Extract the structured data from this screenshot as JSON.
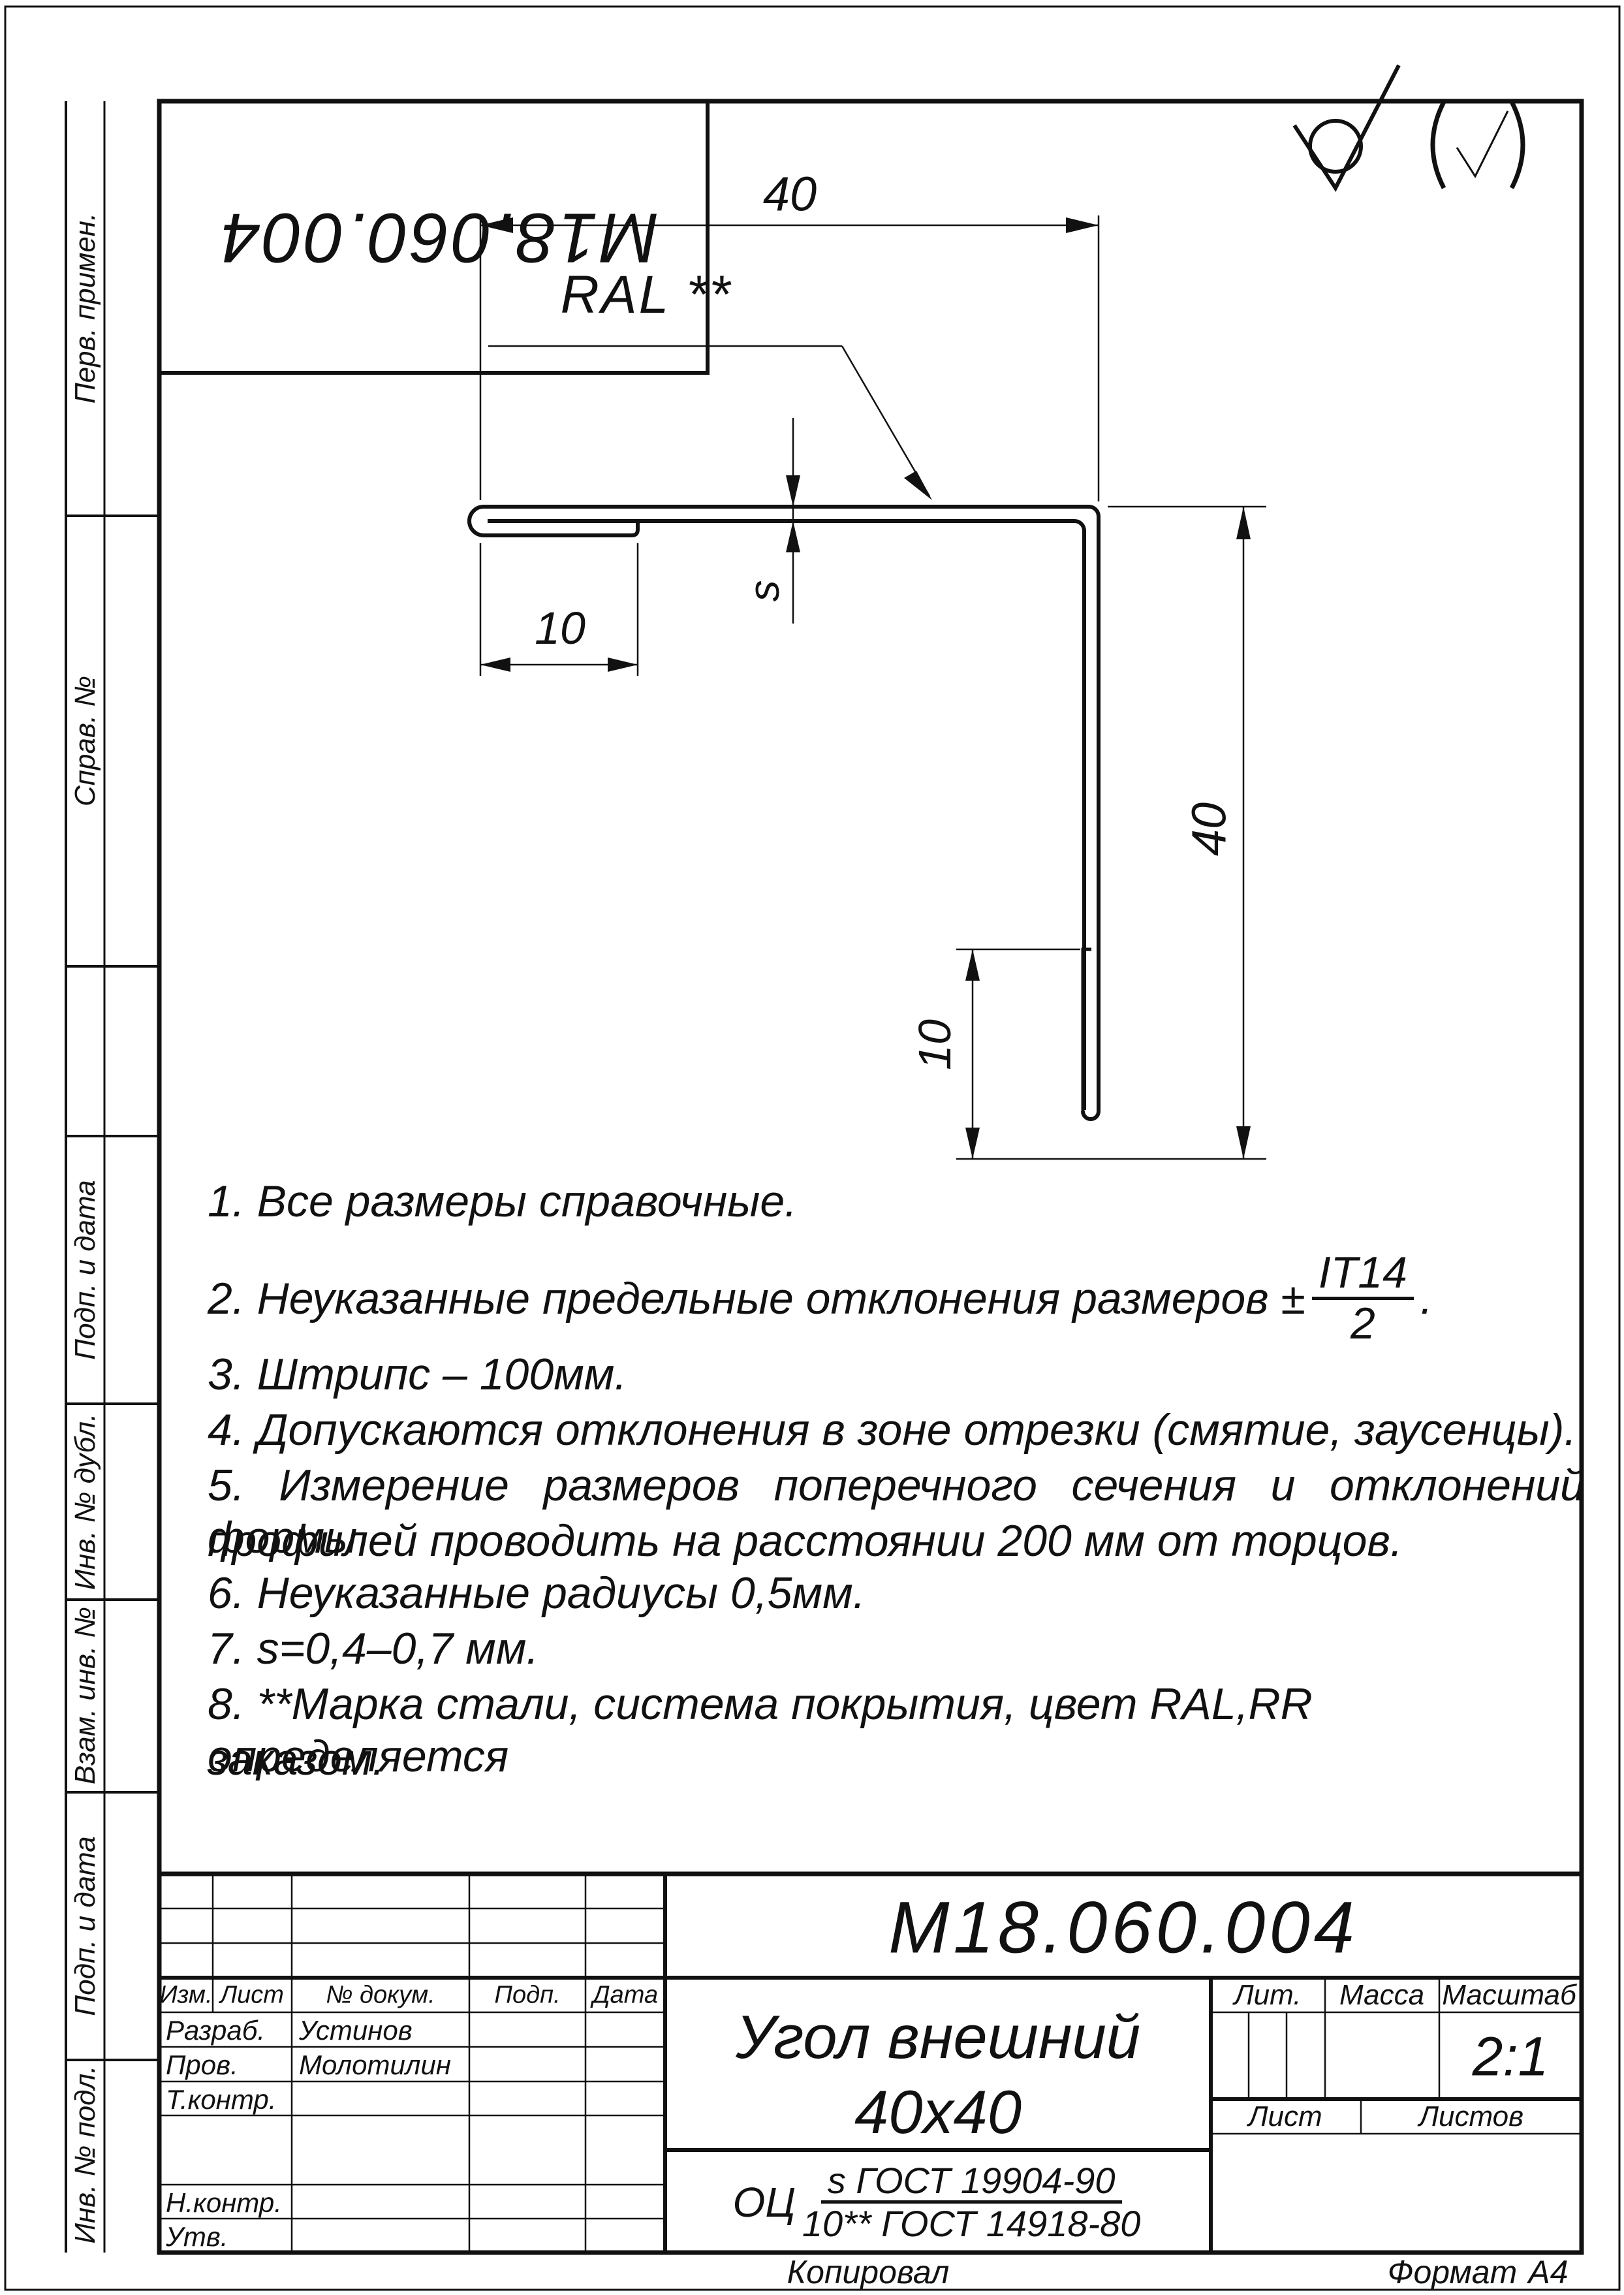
{
  "stamp": {
    "number": "М18.060.004"
  },
  "surface_finish": {
    "main": "machined-not-required",
    "others": "all-other-surfaces"
  },
  "side_labels": {
    "perv": "Перв. примен.",
    "sprav": "Справ. №",
    "podp1": "Подп. и дата",
    "inv_dubl": "Инв. № дубл.",
    "vzam": "Взам. инв. №",
    "podp2": "Подп. и дата",
    "inv_podl": "Инв. № подл."
  },
  "drawing": {
    "dim_width_top": "40",
    "dim_hem_top": "10",
    "thickness_label": "s",
    "dim_height_right": "40",
    "dim_hem_bottom": "10",
    "coating_label": "RAL **"
  },
  "notes": {
    "n1": "1.  Все размеры справочные.",
    "n2_prefix": "2.  Неуказанные предельные отклонения размеров ±",
    "n2_num": "IT14",
    "n2_den": "2",
    "n2_suffix": ".",
    "n3": "3.  Штрипс – 100мм.",
    "n4": "4.  Допускаются отклонения в зоне отрезки (смятие, заусенцы).",
    "n5a": "5.  Измерение размеров поперечного сечения и отклонений формы",
    "n5b": "профилей проводить на расстоянии 200 мм от торцов.",
    "n6": "6.  Неуказанные радиусы 0,5мм.",
    "n7": "7.  s=0,4–0,7 мм.",
    "n8a": "8.  **Марка стали, система покрытия, цвет RAL,RR определяется",
    "n8b": "заказом."
  },
  "title_block": {
    "designation": "М18.060.004",
    "name_line1": "Угол внешний",
    "name_line2": "40х40",
    "material_prefix": "ОЦ",
    "material_num": "s ГОСТ 19904-90",
    "material_den": "10** ГОСТ 14918-80",
    "col_izm": "Изм.",
    "col_list": "Лист",
    "col_docnum": "№ докум.",
    "col_podp": "Подп.",
    "col_data": "Дата",
    "row_razrab": "Разраб.",
    "razrab_name": "Устинов",
    "row_prov": "Пров.",
    "prov_name": "Молотилин",
    "row_tkontr": "Т.контр.",
    "row_nkontr": "Н.контр.",
    "row_utv": "Утв.",
    "lit_label": "Лит.",
    "massa_label": "Масса",
    "masshtab_label": "Масштаб",
    "scale_value": "2:1",
    "list_label": "Лист",
    "listov_label": "Листов"
  },
  "footer": {
    "copied": "Копировал",
    "format_label": "Формат",
    "format_value": "А4"
  }
}
